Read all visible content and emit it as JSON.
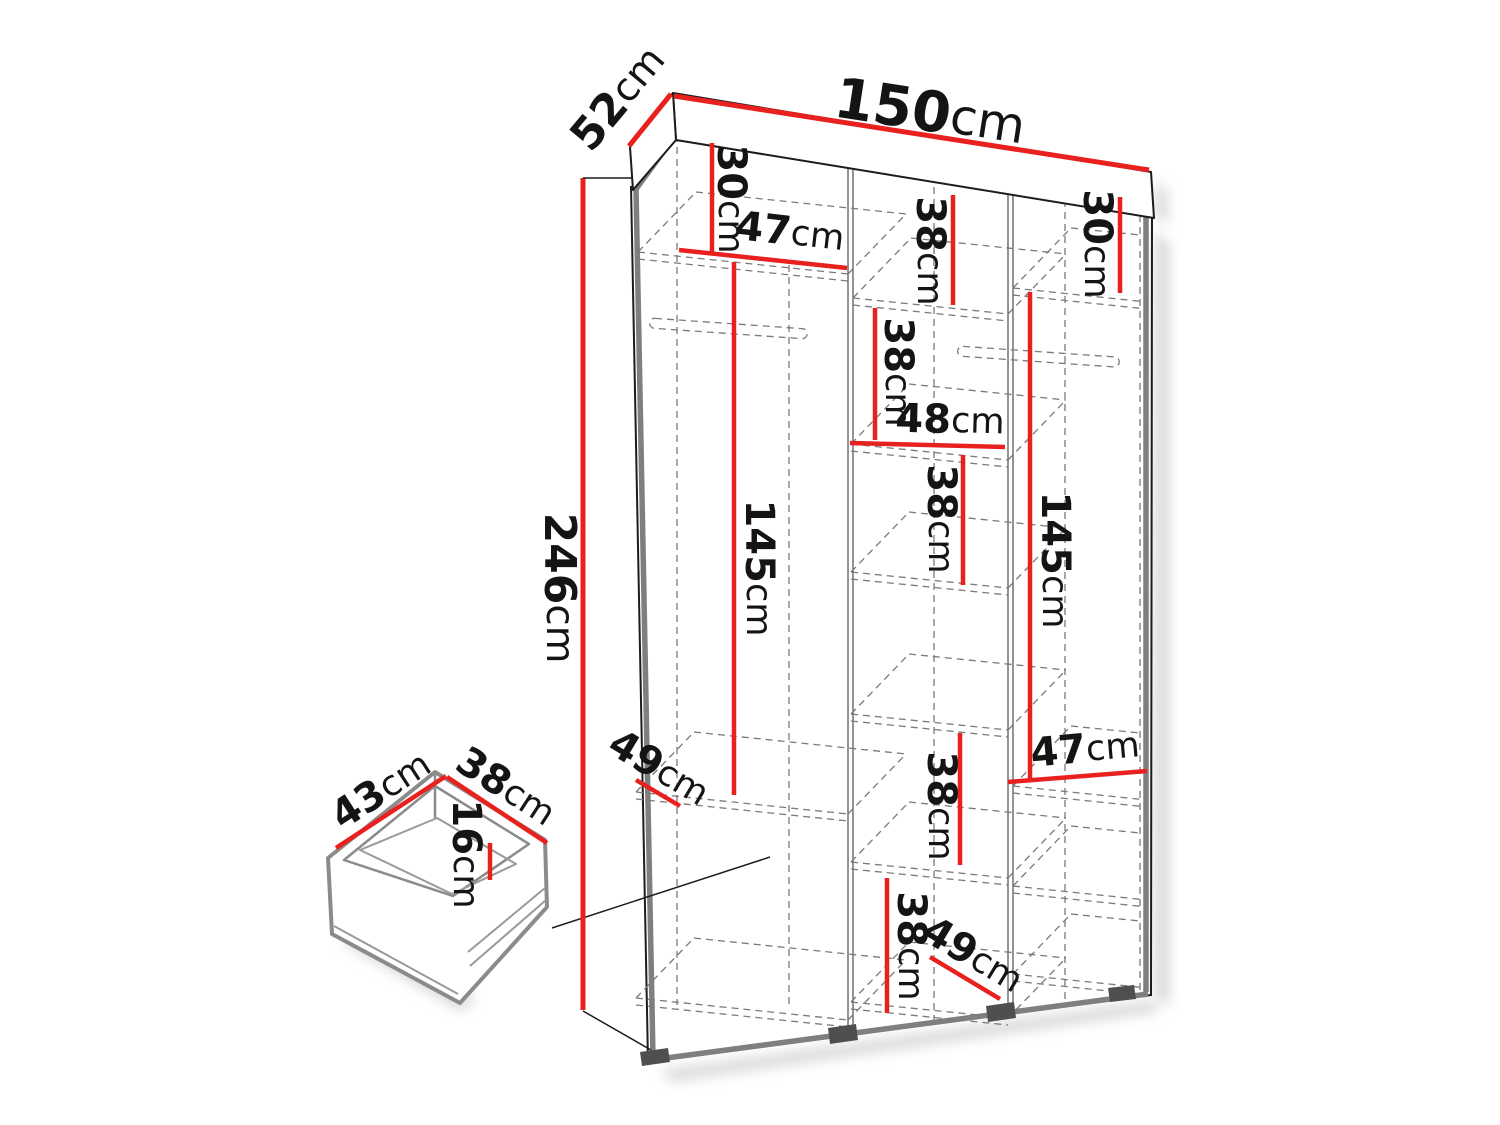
{
  "figure": {
    "kind": "furniture-dimension-diagram",
    "subject": "three-column wardrobe with internal shelves, hanging rails and a drawer detail"
  },
  "colors": {
    "dimension_red": "#e8211f",
    "outline_black": "#1c1c1c",
    "structure_gray": "#7f7f7f",
    "hidden_line_gray": "#7a7a7a"
  },
  "labels": {
    "overall_width": {
      "value": "150",
      "unit": "cm"
    },
    "overall_depth": {
      "value": "52",
      "unit": "cm"
    },
    "overall_height": {
      "value": "246",
      "unit": "cm"
    },
    "left_top_section": {
      "value": "30",
      "unit": "cm"
    },
    "left_shelf_width": {
      "value": "47",
      "unit": "cm"
    },
    "left_hanging_height": {
      "value": "145",
      "unit": "cm"
    },
    "left_bottom_depth": {
      "value": "49",
      "unit": "cm"
    },
    "middle_top_section": {
      "value": "38",
      "unit": "cm"
    },
    "middle_section_2": {
      "value": "38",
      "unit": "cm"
    },
    "middle_shelf_width": {
      "value": "48",
      "unit": "cm"
    },
    "middle_section_3": {
      "value": "38",
      "unit": "cm"
    },
    "middle_section_4": {
      "value": "38",
      "unit": "cm"
    },
    "middle_section_5": {
      "value": "38",
      "unit": "cm"
    },
    "middle_bottom_depth": {
      "value": "49",
      "unit": "cm"
    },
    "right_top_section": {
      "value": "30",
      "unit": "cm"
    },
    "right_hanging_height": {
      "value": "145",
      "unit": "cm"
    },
    "right_shelf_width": {
      "value": "47",
      "unit": "cm"
    },
    "drawer_width": {
      "value": "43",
      "unit": "cm"
    },
    "drawer_depth": {
      "value": "38",
      "unit": "cm"
    },
    "drawer_height": {
      "value": "16",
      "unit": "cm"
    }
  }
}
